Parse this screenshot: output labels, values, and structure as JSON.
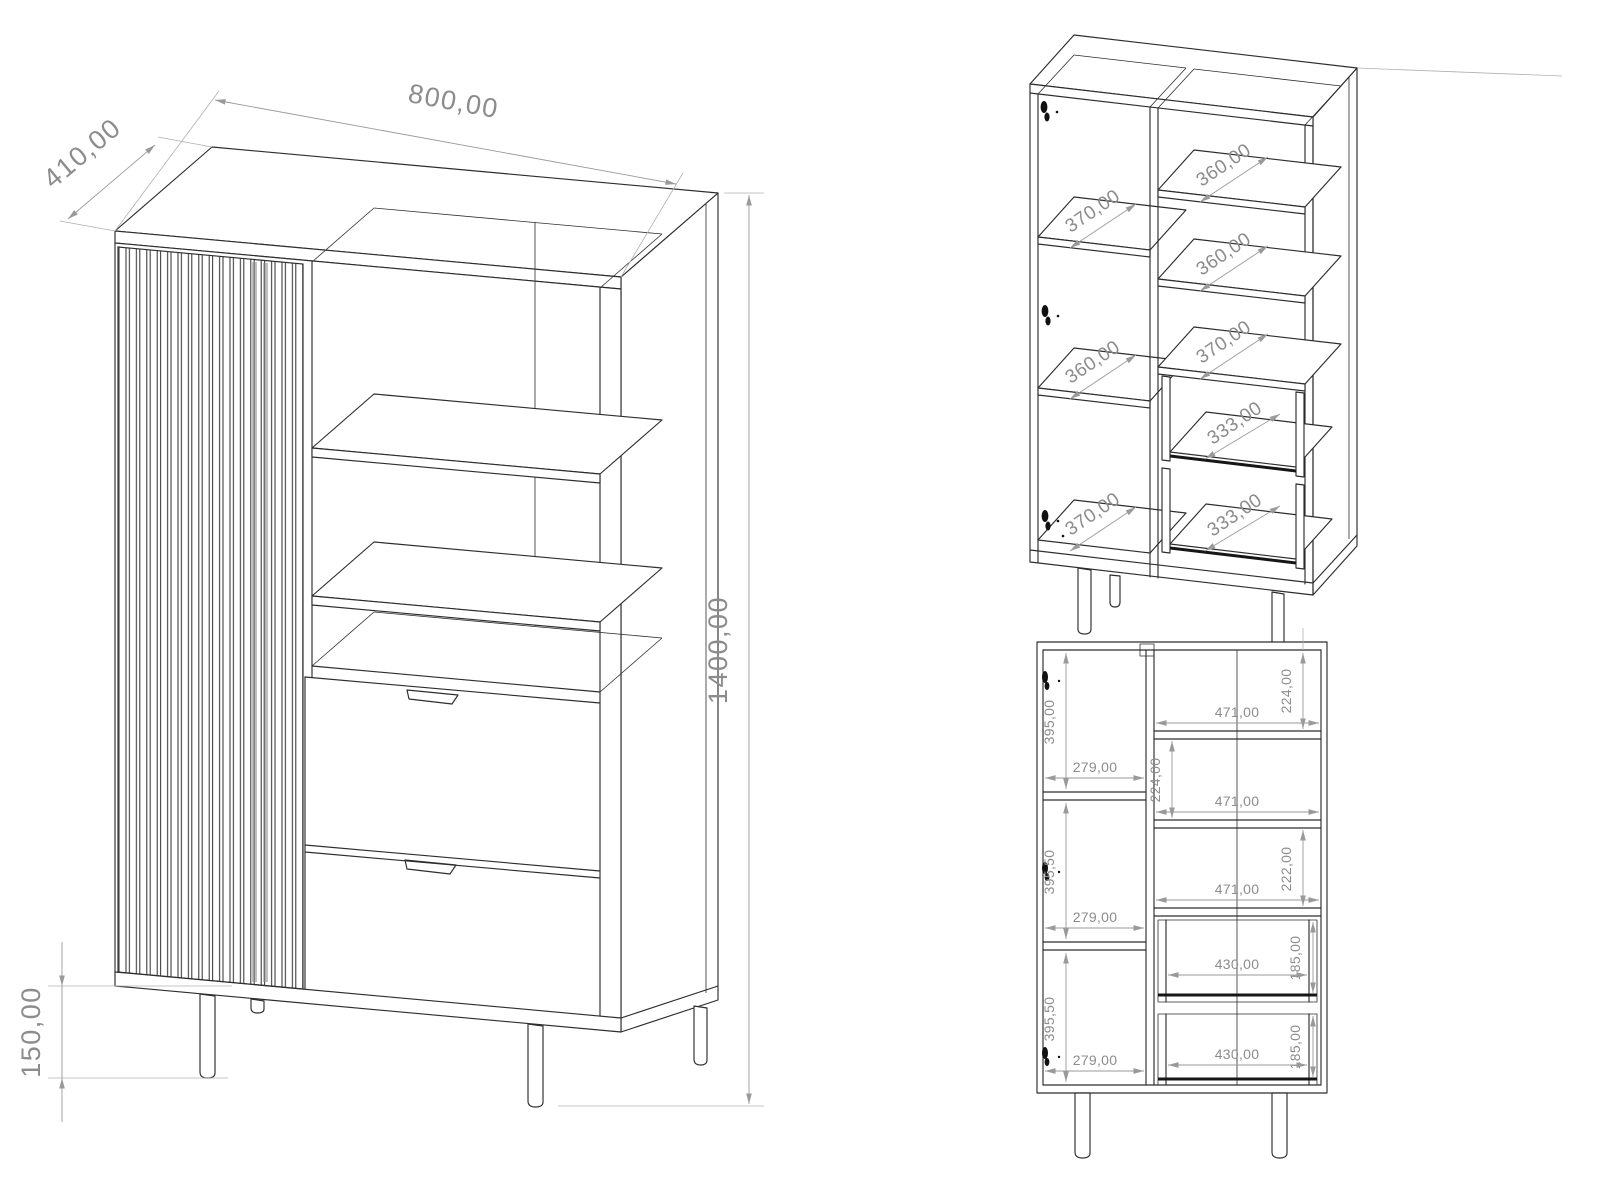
{
  "main_view": {
    "dim_width": "800,00",
    "dim_depth": "410,00",
    "dim_height": "1400,00",
    "dim_leg_height": "150,00"
  },
  "interior_view": {
    "left_column_depths": [
      "370,00",
      "360,00",
      "370,00"
    ],
    "right_column_depths": [
      "360,00",
      "360,00",
      "370,00"
    ],
    "drawer_depths": [
      "333,00",
      "333,00"
    ]
  },
  "front_view": {
    "left_column": [
      {
        "height": "395,00",
        "width": "279,00"
      },
      {
        "height": "395,50",
        "width": "279,00"
      },
      {
        "height": "395,50",
        "width": "279,00"
      }
    ],
    "right_column": [
      {
        "height": "224,00",
        "width": "471,00"
      },
      {
        "height": "224,00",
        "width": "471,00"
      },
      {
        "height": "222,00",
        "width": "471,00"
      }
    ],
    "drawers": [
      {
        "height": "185,00",
        "width": "430,00"
      },
      {
        "height": "185,00",
        "width": "430,00"
      }
    ]
  },
  "colors": {
    "background": "#ffffff",
    "outline": "#2d2d2d",
    "dimension": "#8c8c8c"
  }
}
